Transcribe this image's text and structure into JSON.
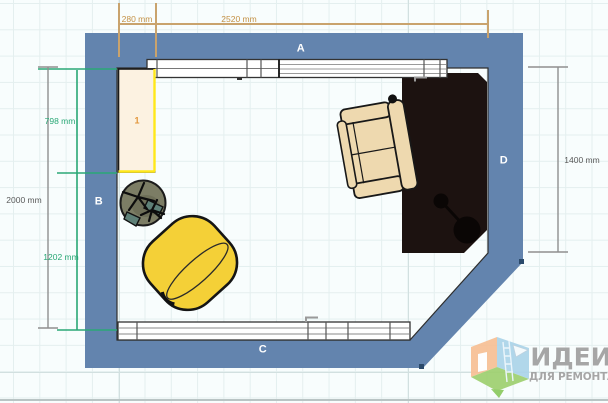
{
  "canvas": {
    "grid": "on",
    "background": "#f8fdfd"
  },
  "plan": {
    "wall_labels": {
      "top": "A",
      "left": "B",
      "bottom": "C",
      "right": "D"
    },
    "dimensions": {
      "top_offset": "280 mm",
      "top_width": "2520 mm",
      "left_total": "2000 mm",
      "left_upper": "798 mm",
      "left_lower": "1202 mm",
      "right_height": "1400 mm"
    },
    "furniture": {
      "wardrobe_badge": "1",
      "items": [
        "wardrobe",
        "office-chair",
        "barrel-armchair",
        "lounge-armchair",
        "rug",
        "arc-floor-lamp",
        "window-top",
        "window-bottom"
      ]
    }
  },
  "watermark": {
    "title": "ИДЕИ",
    "subtitle": "ДЛЯ РЕМОНТА"
  },
  "colors": {
    "wall": "#6384ae",
    "rug": "#1c1210",
    "lamp": "#0a0605",
    "armchair_yellow": "#f4d037",
    "sofa_cream": "#eed9af",
    "office_chair": "#7c7d65",
    "office_chair_shade": "#6e6f58",
    "office_chair_armrest": "#5e8077",
    "wardrobe_fill": "#fcf2e1",
    "wardrobe_accent": "#ffe81a",
    "window_fill": "#ffffff",
    "dim_tan": "#c9a36d",
    "dim_green": "#2aa876",
    "dim_gray": "#8f8f8f",
    "handle": "#2b4a6b"
  }
}
